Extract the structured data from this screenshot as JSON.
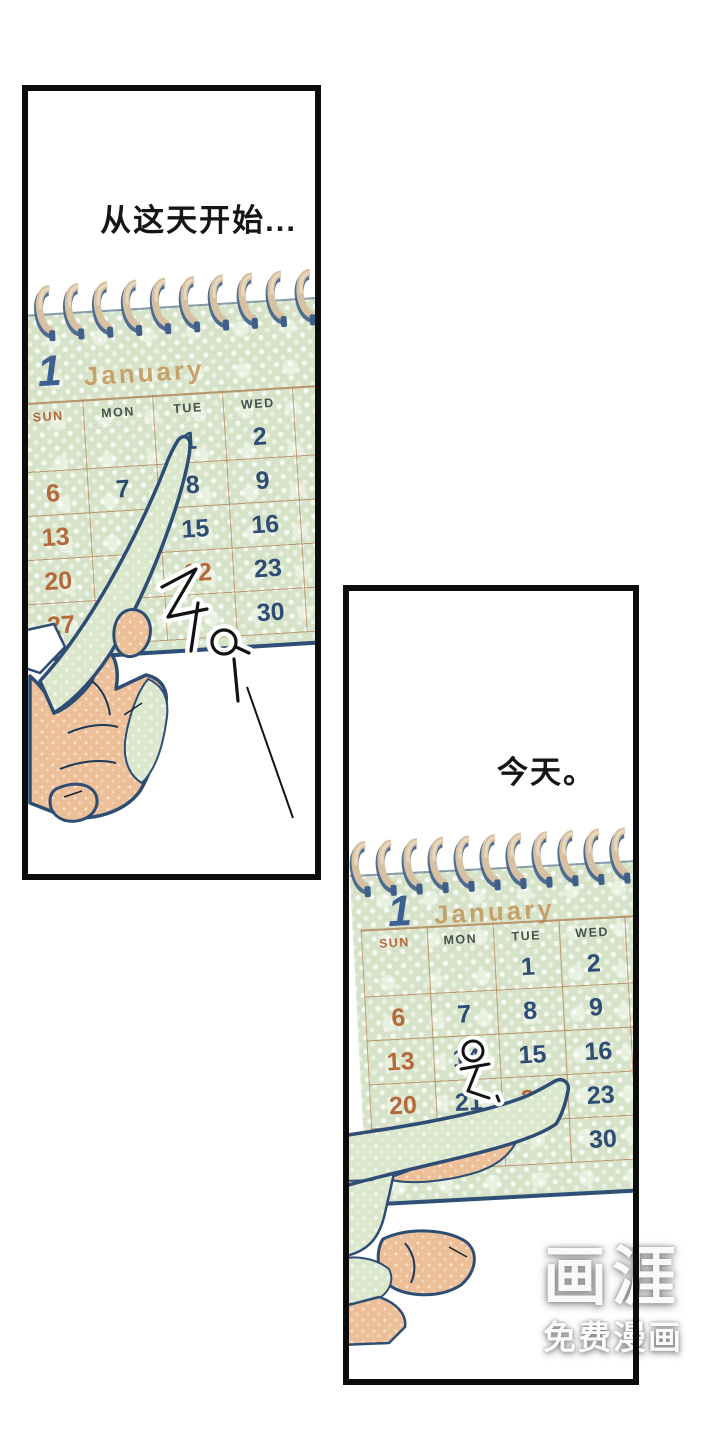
{
  "panel1": {
    "caption": "从这天开始...",
    "sfx": "주우",
    "calendar": {
      "month_number": "1",
      "month_name": "January",
      "weekdays": [
        "SUN",
        "MON",
        "TUE",
        "WED"
      ],
      "dates": [
        {
          "label": "1",
          "tone": "navy"
        },
        {
          "label": "2",
          "tone": "navy"
        },
        {
          "label": "6",
          "tone": "orange"
        },
        {
          "label": "7",
          "tone": "navy"
        },
        {
          "label": "8",
          "tone": "navy"
        },
        {
          "label": "9",
          "tone": "navy"
        },
        {
          "label": "13",
          "tone": "orange"
        },
        {
          "label": "15",
          "tone": "navy"
        },
        {
          "label": "16",
          "tone": "navy"
        },
        {
          "label": "20",
          "tone": "orange"
        },
        {
          "label": "22",
          "tone": "orange"
        },
        {
          "label": "23",
          "tone": "navy"
        },
        {
          "label": "27",
          "tone": "orange"
        },
        {
          "label": "28",
          "tone": "navy"
        },
        {
          "label": "30",
          "tone": "navy"
        }
      ]
    }
  },
  "panel2": {
    "caption": "今天。",
    "sfx": "욱",
    "calendar": {
      "month_number": "1",
      "month_name": "January",
      "weekdays": [
        "SUN",
        "MON",
        "TUE",
        "WED"
      ],
      "dates": [
        {
          "label": "1",
          "tone": "navy"
        },
        {
          "label": "2",
          "tone": "navy"
        },
        {
          "label": "6",
          "tone": "orange"
        },
        {
          "label": "7",
          "tone": "navy"
        },
        {
          "label": "8",
          "tone": "navy"
        },
        {
          "label": "9",
          "tone": "navy"
        },
        {
          "label": "13",
          "tone": "orange"
        },
        {
          "label": "14",
          "tone": "navy"
        },
        {
          "label": "15",
          "tone": "navy"
        },
        {
          "label": "16",
          "tone": "navy"
        },
        {
          "label": "20",
          "tone": "orange"
        },
        {
          "label": "21",
          "tone": "navy"
        },
        {
          "label": "22",
          "tone": "orange"
        },
        {
          "label": "23",
          "tone": "navy"
        },
        {
          "label": "30",
          "tone": "navy"
        }
      ]
    }
  },
  "watermark": {
    "logo": "画涯",
    "tagline": "免费漫画"
  },
  "colors": {
    "panel_border": "#0c0c0c",
    "card_green": "#d6e3c8",
    "grid_line": "#b08052",
    "date_navy": "#2e4d74",
    "date_orange": "#b5683a",
    "month_number_blue": "#3d6093",
    "month_name_tan": "#c49a60",
    "binding_tan": "#d6c2a2",
    "binding_navy": "#3f5e8a",
    "skin": "#ecbf98",
    "hand_green": "#dbe7cc",
    "outline_navy": "#2e4d74"
  }
}
